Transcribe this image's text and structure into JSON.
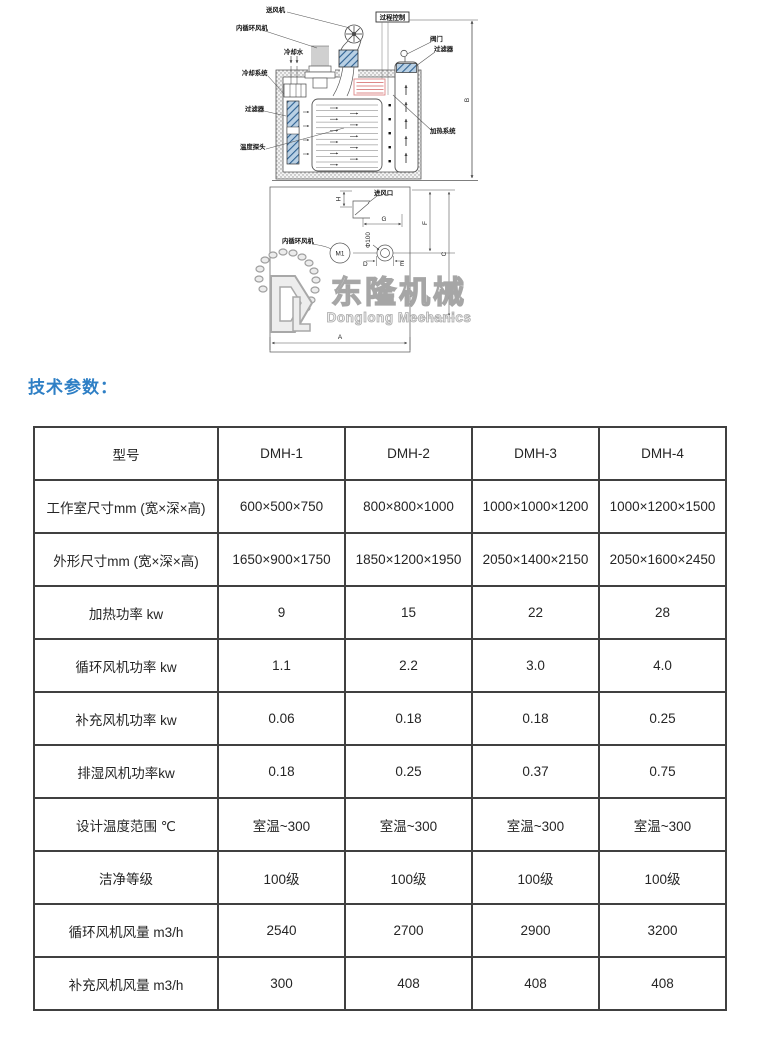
{
  "page": {
    "heading": "技术参数："
  },
  "diagram": {
    "labels": {
      "fan_top": "送风机",
      "inner_fan_top": "内循环风机",
      "cooling_water": "冷却水",
      "cooling_system": "冷却系统",
      "filter_left": "过滤器",
      "temp_probe": "温度探头",
      "process_control": "过程控制",
      "valve": "阀门",
      "filter_right": "过滤器",
      "heating_system": "加热系统",
      "air_inlet": "进风口",
      "inner_fan_plan": "内循环风机",
      "motor": "M1",
      "phi": "Φ100"
    },
    "dims": {
      "A": "A",
      "B": "B",
      "C": "C",
      "D": "D",
      "E": "E",
      "F": "F",
      "G": "G",
      "H": "H"
    },
    "watermark": {
      "brand": "东隆机械",
      "sub": "Donglong Mechanics"
    }
  },
  "table": {
    "header": [
      "型号",
      "DMH-1",
      "DMH-2",
      "DMH-3",
      "DMH-4"
    ],
    "rows": [
      {
        "label": "工作室尺寸mm (宽×深×高)",
        "values": [
          "600×500×750",
          "800×800×1000",
          "1000×1000×1200",
          "1000×1200×1500"
        ]
      },
      {
        "label": "外形尺寸mm (宽×深×高)",
        "values": [
          "1650×900×1750",
          "1850×1200×1950",
          "2050×1400×2150",
          "2050×1600×2450"
        ]
      },
      {
        "label": "加热功率  kw",
        "values": [
          "9",
          "15",
          "22",
          "28"
        ]
      },
      {
        "label": "循环风机功率  kw",
        "values": [
          "1.1",
          "2.2",
          "3.0",
          "4.0"
        ]
      },
      {
        "label": "补充风机功率   kw",
        "values": [
          "0.06",
          "0.18",
          "0.18",
          "0.25"
        ]
      },
      {
        "label": "排湿风机功率kw",
        "values": [
          "0.18",
          "0.25",
          "0.37",
          "0.75"
        ]
      },
      {
        "label": "设计温度范围    ℃",
        "values": [
          "室温~300",
          "室温~300",
          "室温~300",
          "室温~300"
        ]
      },
      {
        "label": "洁净等级",
        "values": [
          "100级",
          "100级",
          "100级",
          "100级"
        ]
      },
      {
        "label": "循环风机风量  m3/h",
        "values": [
          "2540",
          "2700",
          "2900",
          "3200"
        ]
      },
      {
        "label": "补充风机风量    m3/h",
        "values": [
          "300",
          "408",
          "408",
          "408"
        ]
      }
    ]
  },
  "colors": {
    "heading_blue": "#2e7fc5",
    "table_border": "#404040",
    "filter_blue": "#2f6293",
    "heater_red": "#dd8888",
    "watermark_gray": "#a8a8a8"
  }
}
